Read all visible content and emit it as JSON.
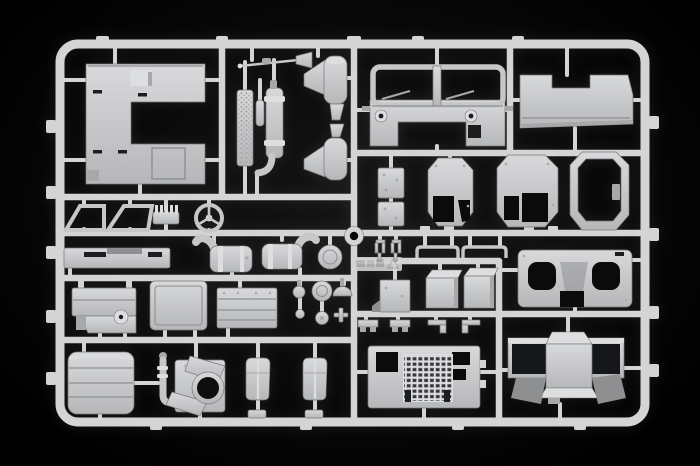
{
  "scene": {
    "type": "photograph",
    "subject": "Unassembled plastic model kit sprue (injection-moulded truck parts tree) on a black background",
    "text_visible": "none (only an illegible embossed mould stamp on one runner)",
    "palette": {
      "bg": "#000000",
      "vignette": "#141516",
      "runner": "#d3d4d3",
      "plastic": "#c6c7c9",
      "plastic-light": "#dddee0",
      "plastic-dark": "#a7a8aa",
      "shade": "#8e8f91",
      "edge": "#77787a",
      "hole": "#0b0b0b",
      "slot": "#1c1d1e"
    }
  },
  "parts": {
    "frame": {
      "name": "sprue-frame",
      "desc": "rounded rectangular runner frame with internal cross runners and outer gate tabs"
    },
    "locator_ring": {
      "name": "sprue-locator-ring",
      "desc": "round locator eyelet at centre of sprue"
    },
    "mold_stamp": {
      "name": "mould-stamp",
      "desc": "illegible embossed marking with recycling triangle on runner pad"
    },
    "cab_roof": {
      "name": "cab-roof-panel",
      "desc": "large C-shaped roof panel with hatch and slots"
    },
    "tread_strip": {
      "name": "tread-plate-strip",
      "desc": "textured tread plate strip"
    },
    "small_cylinder": {
      "name": "small-cylinder",
      "desc": "small cylindrical fitting"
    },
    "muffler": {
      "name": "exhaust-muffler",
      "desc": "cylindrical muffler with elbow pipe"
    },
    "antenna": {
      "name": "antenna-rod",
      "desc": "thin antenna rod with base"
    },
    "stack_upper": {
      "name": "exhaust-stack-upper",
      "desc": "conical exhaust stack"
    },
    "stack_lower": {
      "name": "exhaust-stack-lower",
      "desc": "conical exhaust stack, lower"
    },
    "cab_front": {
      "name": "cab-front-panel",
      "desc": "cab front with twin windshield frames, wipers and headlights"
    },
    "cab_rear": {
      "name": "cab-rear-panel",
      "desc": "large rear cab panel with top notch"
    },
    "window_left": {
      "name": "window-frame-left",
      "desc": "trapezoid door window frame"
    },
    "window_right": {
      "name": "window-frame-right",
      "desc": "trapezoid door window frame"
    },
    "finned_part": {
      "name": "finned-engine-part",
      "desc": "small finned block"
    },
    "steering_wheel": {
      "name": "steering-wheel",
      "desc": "three-spoke steering wheel"
    },
    "hinge_upper": {
      "name": "hinge-plate-upper",
      "desc": "small riveted plate"
    },
    "hinge_lower": {
      "name": "hinge-plate-lower",
      "desc": "small riveted plate"
    },
    "door_small": {
      "name": "door-panel-small",
      "desc": "octagonal door panel with window cutouts"
    },
    "door_large": {
      "name": "door-panel-large",
      "desc": "octagonal door panel with window cutouts"
    },
    "door_frame": {
      "name": "door-frame-open",
      "desc": "hollow octagonal door frame"
    },
    "bumper": {
      "name": "front-bumper-bar",
      "desc": "stepped bumper bar with slots"
    },
    "air_cleaner_l": {
      "name": "air-cleaner-left",
      "desc": "cylindrical air cleaner with curved intake horn"
    },
    "air_cleaner_r": {
      "name": "air-cleaner-right",
      "desc": "cylindrical air cleaner with curved intake horn"
    },
    "headlight_disc": {
      "name": "headlight-disc",
      "desc": "round disc part"
    },
    "hooks": {
      "name": "mirror-bracket-pair",
      "desc": "two small fork brackets"
    },
    "arm_left": {
      "name": "mirror-arm-left",
      "desc": "wide U-shaped mirror arm"
    },
    "arm_right": {
      "name": "mirror-arm-right",
      "desc": "wide U-shaped mirror arm"
    },
    "box_small": {
      "name": "battery-box-small",
      "desc": "small open box with flange"
    },
    "box_mid": {
      "name": "battery-box-mid",
      "desc": "rectangular box, bright top face"
    },
    "box_large": {
      "name": "battery-box-large",
      "desc": "rectangular box, bright top face"
    },
    "fender": {
      "name": "fender-panel",
      "desc": "panel with two rounded cutouts and bottom notch"
    },
    "fuel_tank": {
      "name": "fuel-tank",
      "desc": "fuel tank with filler stubs and small wheel"
    },
    "equipment_door": {
      "name": "equipment-door-panel",
      "desc": "large rounded access door with inner border"
    },
    "stowage_box": {
      "name": "stowage-box",
      "desc": "ribbed stowage box with rivets"
    },
    "cap_small": {
      "name": "round-cap-small",
      "desc": "small round cap on stem"
    },
    "cap_large": {
      "name": "round-cap-large",
      "desc": "large round cap"
    },
    "dome_cap": {
      "name": "dome-cap",
      "desc": "dome-shaped cap"
    },
    "pin_ball": {
      "name": "pin-ball-small",
      "desc": "small ball pin"
    },
    "lamp_small": {
      "name": "lamp-disc-small",
      "desc": "small lamp disc"
    },
    "cross_fitting": {
      "name": "cross-fitting",
      "desc": "tiny cross-shaped fitting"
    },
    "ribbed_box": {
      "name": "radiator-ribbed-box",
      "desc": "rounded box with horizontal ribs"
    },
    "winch": {
      "name": "winch-fan-assembly",
      "desc": "winch/fan assembly with piping and large round opening"
    },
    "seat_left": {
      "name": "seat-backrest-left",
      "desc": "rounded seat backrest"
    },
    "seat_right": {
      "name": "seat-backrest-right",
      "desc": "rounded seat backrest"
    },
    "dashboard": {
      "name": "dashboard-panel",
      "desc": "instrument panel with dark vent grille grid and cutouts"
    },
    "cab_floor": {
      "name": "cab-floor-assembly",
      "desc": "cab floor with engine tunnel and twin wheel boxes"
    },
    "step_brackets": {
      "name": "step-brackets",
      "desc": "row of small pedal/step brackets"
    },
    "gates": {
      "name": "sprue-gates",
      "desc": "short gate stubs joining parts to runners"
    }
  }
}
